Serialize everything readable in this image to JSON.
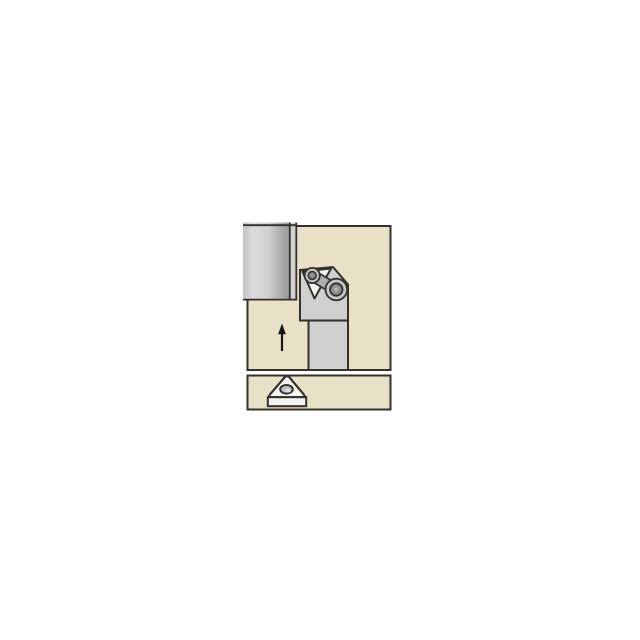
{
  "diagram": {
    "kind": "turning-toolholder-application-icon",
    "colors": {
      "background": "#ffffff",
      "outline": "#32312c",
      "panel_fill": "#e9e0c8",
      "workpiece_left": "#c4c4c4",
      "workpiece_light": "#dcdcdc",
      "workpiece_mid": "#cfcfcf",
      "workpiece_dark": "#a8a8a8",
      "workpiece_edge": "#9a9a9a",
      "machined_stripe": "#d4d4d4",
      "holder_gray": "#d0d0d0",
      "insert_white": "#f5f4f0",
      "clamp_gray": "#aeaeae",
      "screw_ring": "#c6c6c6",
      "screw_core": "#8e8e8e",
      "screw_center": "#b5b5b5",
      "hole_fill": "#c2c2c2",
      "hole_highlight": "#e6e6e6",
      "arrow": "#161614"
    },
    "panels": {
      "main": {
        "x": 247.5,
        "y": 226,
        "width": 143,
        "height": 144
      },
      "detail": {
        "x": 247.5,
        "y": 375.5,
        "width": 143,
        "height": 34
      }
    },
    "workpiece": {
      "body": {
        "x": 243,
        "y": 222.5,
        "width": 47,
        "height": 77
      },
      "stripe": {
        "x": 290.5,
        "y": 222.5,
        "width": 5.5,
        "height": 77
      },
      "strokes_path": "M243,225.2 H296.8 M289.8,222.5 V299.6 M296.3,222.5 V299.6 M243,299.6 H297.3"
    },
    "toolholder": {
      "head_points": "300,270 333,267 348,284.5 348,320.5 300,320.5",
      "shank": {
        "x": 308.5,
        "y": 320.5,
        "width": 39.5,
        "height": 49.5
      },
      "insert_points": "302.5,271.5 331,268.5 314.5,298.5",
      "clamp": {
        "x1": 312.2,
        "y1": 275.5,
        "x2": 336.3,
        "y2": 289.5
      },
      "screw_big": {
        "cx": 336.3,
        "cy": 289.5,
        "r_outer": 10.8,
        "r_inner": 6.2,
        "r_center": 2.2
      },
      "screw_small": {
        "cx": 312.2,
        "cy": 275.5,
        "r_outer": 7.6,
        "r_inner": 3.9
      }
    },
    "feed_arrow": {
      "shaft": {
        "x1": 282,
        "y1": 351,
        "x2": 282,
        "y2": 333.5
      },
      "head_points": "282,323.5 278.1,334.3 285.9,334.3"
    },
    "insert_icon": {
      "top_face_path": "M284.4,377.6 L270.2,394.2 Q267.6,397.2 271.6,397.2 L302.2,397.2 Q306.2,397.2 303.6,394.2 L289.6,377.6 Q287,374.6 284.4,377.6 Z",
      "side_face": {
        "x": 267.8,
        "y": 397.2,
        "width": 38.4,
        "height": 9
      },
      "hole": {
        "cx": 286.5,
        "cy": 389.3,
        "rx": 6.3,
        "ry": 4.3
      },
      "hole_highlight": {
        "cx": 288.3,
        "cy": 390.8,
        "rx": 2.6,
        "ry": 1.7
      }
    }
  }
}
